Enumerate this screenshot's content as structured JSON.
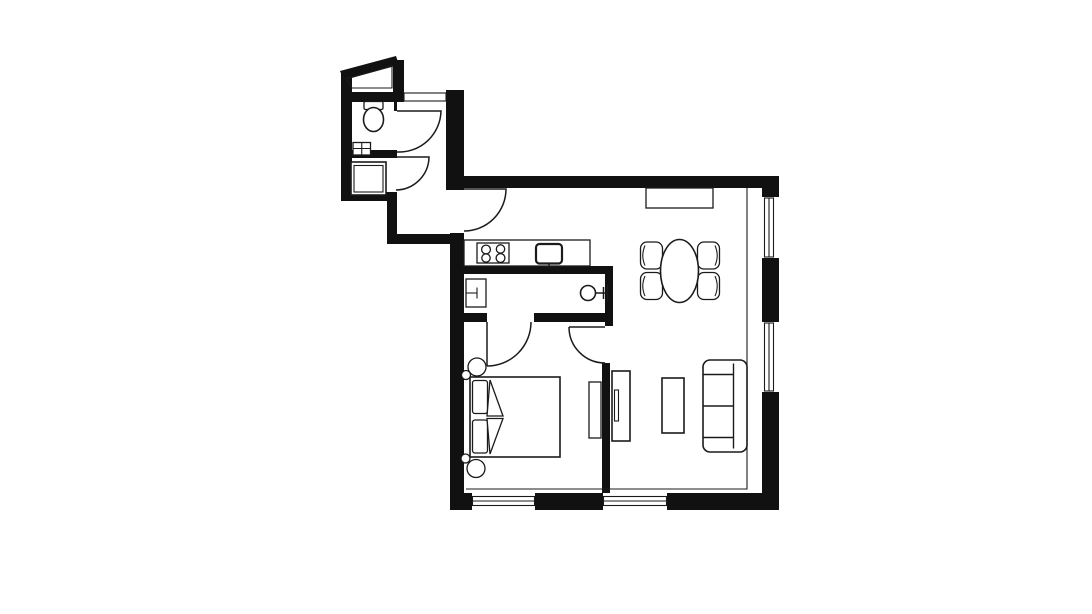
{
  "title": "Apartment floor plan",
  "canvas": {
    "width": 1092,
    "height": 614,
    "background": "#ffffff"
  },
  "colors": {
    "wall": "#111111",
    "line": "#1b1b1b",
    "floor": "#ffffff"
  },
  "rooms": [
    {
      "name": "wc-room",
      "position": "top-left",
      "fixtures": [
        "toilet",
        "small-washbasin"
      ]
    },
    {
      "name": "bathroom",
      "position": "left, below wc-room",
      "fixtures": [
        "shower-tray"
      ]
    },
    {
      "name": "hallway",
      "position": "between wc block and main area",
      "fixtures": [
        "entry-threshold"
      ]
    },
    {
      "name": "kitchen",
      "position": "main area, top-left",
      "fixtures": [
        "countertop",
        "cooktop-4-burners",
        "kitchen-sink"
      ]
    },
    {
      "name": "dining-area",
      "position": "main area, top-right",
      "fixtures": [
        "sideboard",
        "oval-table",
        "chair",
        "chair",
        "chair",
        "chair"
      ]
    },
    {
      "name": "living-area",
      "position": "main area, bottom-right",
      "fixtures": [
        "tv-unit",
        "coffee-table",
        "two-seat-sofa"
      ]
    },
    {
      "name": "bedroom",
      "position": "bottom-left",
      "fixtures": [
        "double-bed",
        "pillow",
        "pillow",
        "duvet-fold",
        "bedside-lamp",
        "bedside-lamp",
        "dresser"
      ]
    },
    {
      "name": "ensuite-utility",
      "position": "between kitchen and bedroom",
      "fixtures": [
        "appliance-refrigerator",
        "round-washbasin-with-tap"
      ]
    }
  ],
  "doors": [
    {
      "name": "wc-door",
      "swings_into": "hallway"
    },
    {
      "name": "bathroom-door",
      "swings_into": "hallway"
    },
    {
      "name": "hallway-to-main-door",
      "swings_into": "kitchen"
    },
    {
      "name": "ensuite-to-bedroom-door",
      "swings_into": "bedroom"
    },
    {
      "name": "main-to-bedroom-door",
      "swings_into": "bedroom"
    }
  ],
  "windows": [
    {
      "name": "right-wall-window-upper",
      "wall": "right"
    },
    {
      "name": "right-wall-window-lower",
      "wall": "right"
    },
    {
      "name": "bottom-wall-window-left",
      "wall": "bottom"
    },
    {
      "name": "bottom-wall-window-right",
      "wall": "bottom"
    }
  ]
}
